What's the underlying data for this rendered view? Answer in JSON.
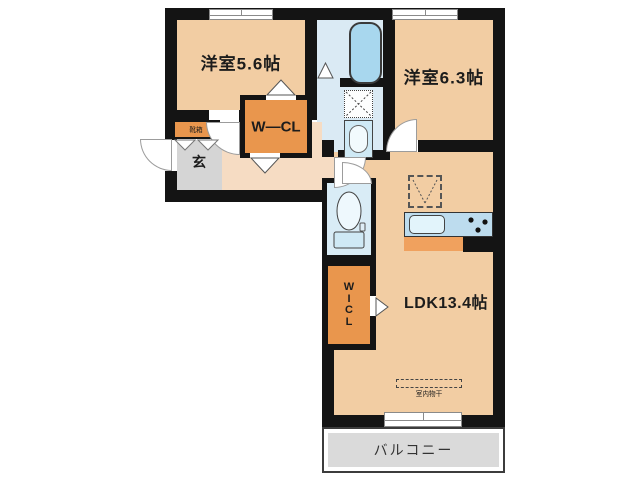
{
  "rooms": {
    "bedroom1": "洋室5.6帖",
    "bedroom2": "洋室6.3帖",
    "ldk": "LDK13.4帖",
    "wcl": "W―CL",
    "wicl": "W\nI\nC\nL",
    "entrance": "玄",
    "shoebox": "靴箱",
    "balcony": "バルコニー",
    "indoor_drying": "室内物干"
  },
  "colors": {
    "wall": "#141414",
    "room_fill": "#f2cda3",
    "hall_fill": "#f6dcc3",
    "closet_fill": "#e9964d",
    "wet_area_fill": "#daeaf4",
    "bathtub_fill": "#a8d7ee",
    "genkan_fill": "#d5d5d5",
    "balcony_fill": "#dadada",
    "counter_fill": "#bddcee",
    "counter_front_fill": "#f0a15e"
  },
  "fixtures": [
    "bathtub",
    "washing-machine-space",
    "washbasin",
    "toilet",
    "refrigerator-space",
    "kitchen-sink",
    "stove-burners",
    "indoor-drying-rod",
    "shoe-cabinet",
    "sliding-window",
    "entrance-door"
  ]
}
